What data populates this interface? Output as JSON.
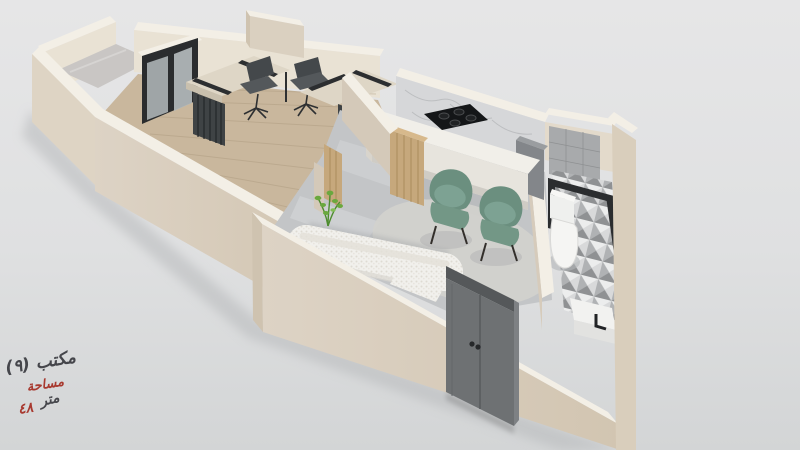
{
  "annotation": {
    "office_label": "مكتب (٩)",
    "area_label": "مساحة",
    "area_value": "٤٨",
    "area_unit": "متر"
  },
  "palette": {
    "background_top": "#e6e6e7",
    "background_bottom": "#d3d5d6",
    "label_color": "#45464b",
    "accent_color": "#a8392f",
    "wall_face": "#dad0c0",
    "wall_top": "#f3efe6",
    "wall_shade": "#cfc3b0",
    "wall_inner": "#e9e2d4",
    "wood_floor": "#c9b79d",
    "marble_floor": "#c3c5c7",
    "backsplash": "#d6d7d9",
    "counter": "#f1efe9",
    "cooktop": "#141618",
    "wood_door": "#c6a87c",
    "entry_door": "#6e7173",
    "sofa": "#f1f0ec",
    "armchair": "#6b8f7f",
    "armchair_cushion": "#7da293",
    "desk_top": "#ded6c6",
    "desk_cabinet": "#3f4345",
    "office_chair": "#54585b",
    "window_frame": "#2a2c2e",
    "plant": "#6aa83e",
    "tile_wall": "#a8aaac",
    "shadow": "#b8babc"
  }
}
